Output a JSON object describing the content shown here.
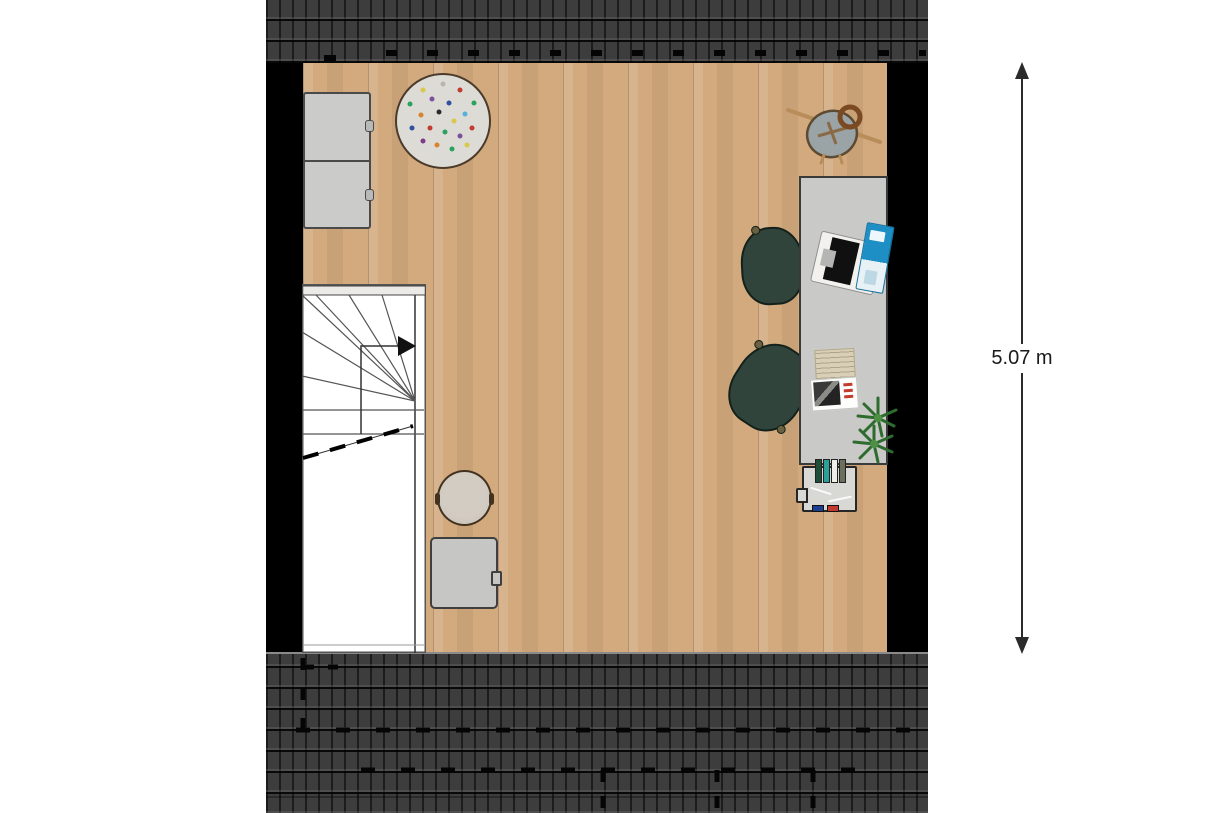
{
  "plan": {
    "type": "floor-plan",
    "level": "attic-study-room",
    "dimension_label": "5.07 m"
  },
  "colors": {
    "wall": "#000000",
    "roofTile": "#3d3d3d",
    "floorWood": "#d2aa7e",
    "desk": "#c9c9c7",
    "cabinet": "#cbcbc9",
    "chairGreen": "#30443c",
    "rugBase": "#dcdbd6",
    "plantGreen": "#2e6b2e",
    "poufBeige": "#c9c1b7",
    "tableGray": "#c6c6c4",
    "notebookBlue": "#1e8fc4",
    "dimensionText": "#1a1a1a"
  },
  "rug": {
    "dots": [
      {
        "x": 28,
        "y": 16,
        "c": "#d9c84a"
      },
      {
        "x": 50,
        "y": 10,
        "c": "#b8b4ac"
      },
      {
        "x": 68,
        "y": 16,
        "c": "#c23b2e"
      },
      {
        "x": 84,
        "y": 30,
        "c": "#2aa15c"
      },
      {
        "x": 14,
        "y": 32,
        "c": "#2aa15c"
      },
      {
        "x": 38,
        "y": 26,
        "c": "#7a4f9e"
      },
      {
        "x": 56,
        "y": 30,
        "c": "#30519e"
      },
      {
        "x": 74,
        "y": 42,
        "c": "#58b0d8"
      },
      {
        "x": 26,
        "y": 44,
        "c": "#d9832e"
      },
      {
        "x": 46,
        "y": 40,
        "c": "#2b2b2b"
      },
      {
        "x": 62,
        "y": 50,
        "c": "#d9c84a"
      },
      {
        "x": 82,
        "y": 58,
        "c": "#c23b2e"
      },
      {
        "x": 16,
        "y": 58,
        "c": "#30519e"
      },
      {
        "x": 36,
        "y": 58,
        "c": "#c23b2e"
      },
      {
        "x": 52,
        "y": 62,
        "c": "#2aa15c"
      },
      {
        "x": 68,
        "y": 66,
        "c": "#7a4f9e"
      },
      {
        "x": 28,
        "y": 72,
        "c": "#7e3a8a"
      },
      {
        "x": 44,
        "y": 76,
        "c": "#d9832e"
      },
      {
        "x": 60,
        "y": 80,
        "c": "#2aa15c"
      },
      {
        "x": 76,
        "y": 76,
        "c": "#d9c84a"
      }
    ]
  },
  "bookshelf": {
    "books_top": [
      "#1e4d3a",
      "#2aa198",
      "#efeee8",
      "#6b705c"
    ],
    "books_bottom": [
      "#1d3f8f",
      "#c23b2e"
    ]
  },
  "objects": [
    "roof-tiles-top",
    "roof-tiles-bottom",
    "left-wall",
    "right-wall",
    "wood-floor",
    "storage-cabinets",
    "polka-dot-rug",
    "bag-with-strap",
    "desk",
    "office-chair",
    "office-chair",
    "laptop",
    "notebook",
    "papers",
    "magazine",
    "plants",
    "bookshelf",
    "winder-staircase",
    "pouf",
    "side-table",
    "vertical-dimension"
  ]
}
